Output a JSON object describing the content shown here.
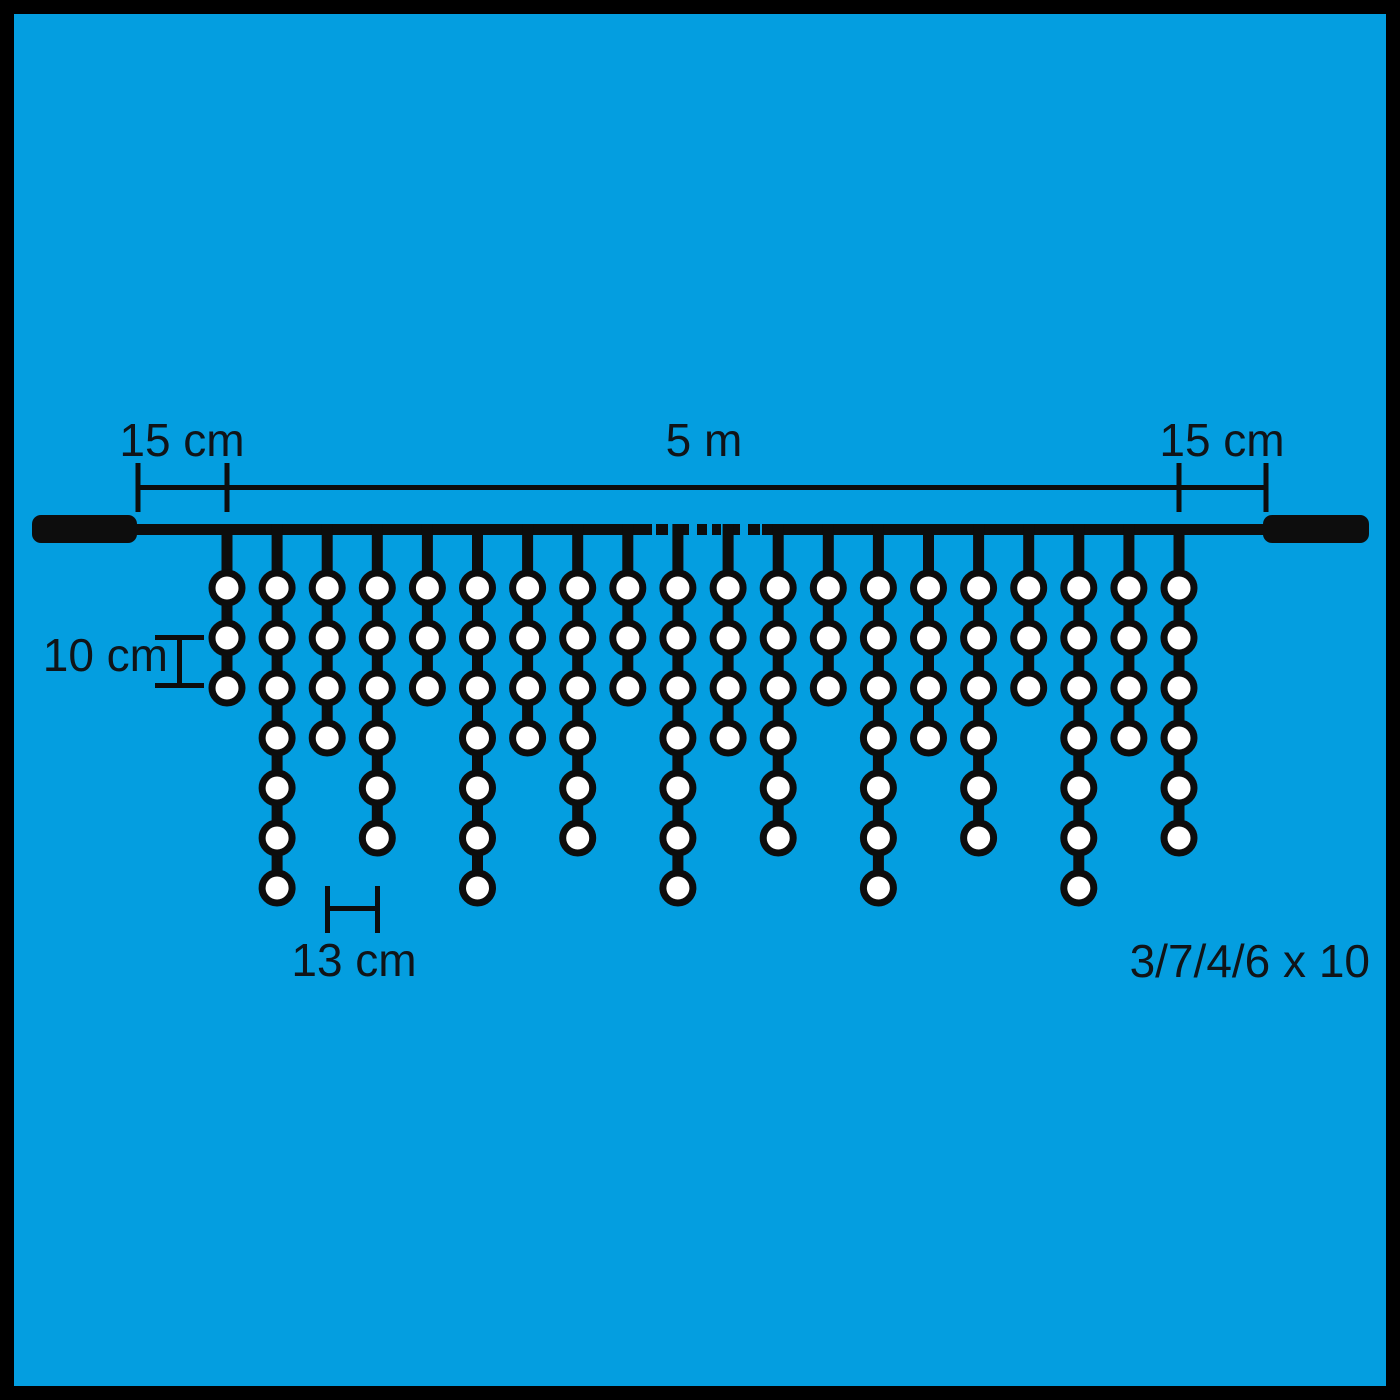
{
  "labels": {
    "left_margin": "15 cm",
    "total_length": "5 m",
    "right_margin": "15 cm",
    "bulb_spacing": "10 cm",
    "drop_spacing": "13 cm",
    "drop_pattern": "3/7/4/6 x 10"
  },
  "diagram": {
    "type": "icicle-light-string",
    "drops_shown": 20,
    "bulb_pattern_per_drop": [
      3,
      7,
      4,
      6
    ],
    "pattern_repeats_shown": 5,
    "bulb_counts_shown": [
      3,
      7,
      4,
      6,
      3,
      7,
      4,
      6,
      3,
      7,
      4,
      6,
      3,
      7,
      4,
      6,
      3,
      7,
      4,
      6
    ],
    "colors": {
      "background": "#049EE0",
      "frame": "#000000",
      "line": "#0D0D0D",
      "bulb_fill": "#FFFFFF",
      "text": "#101418"
    }
  }
}
